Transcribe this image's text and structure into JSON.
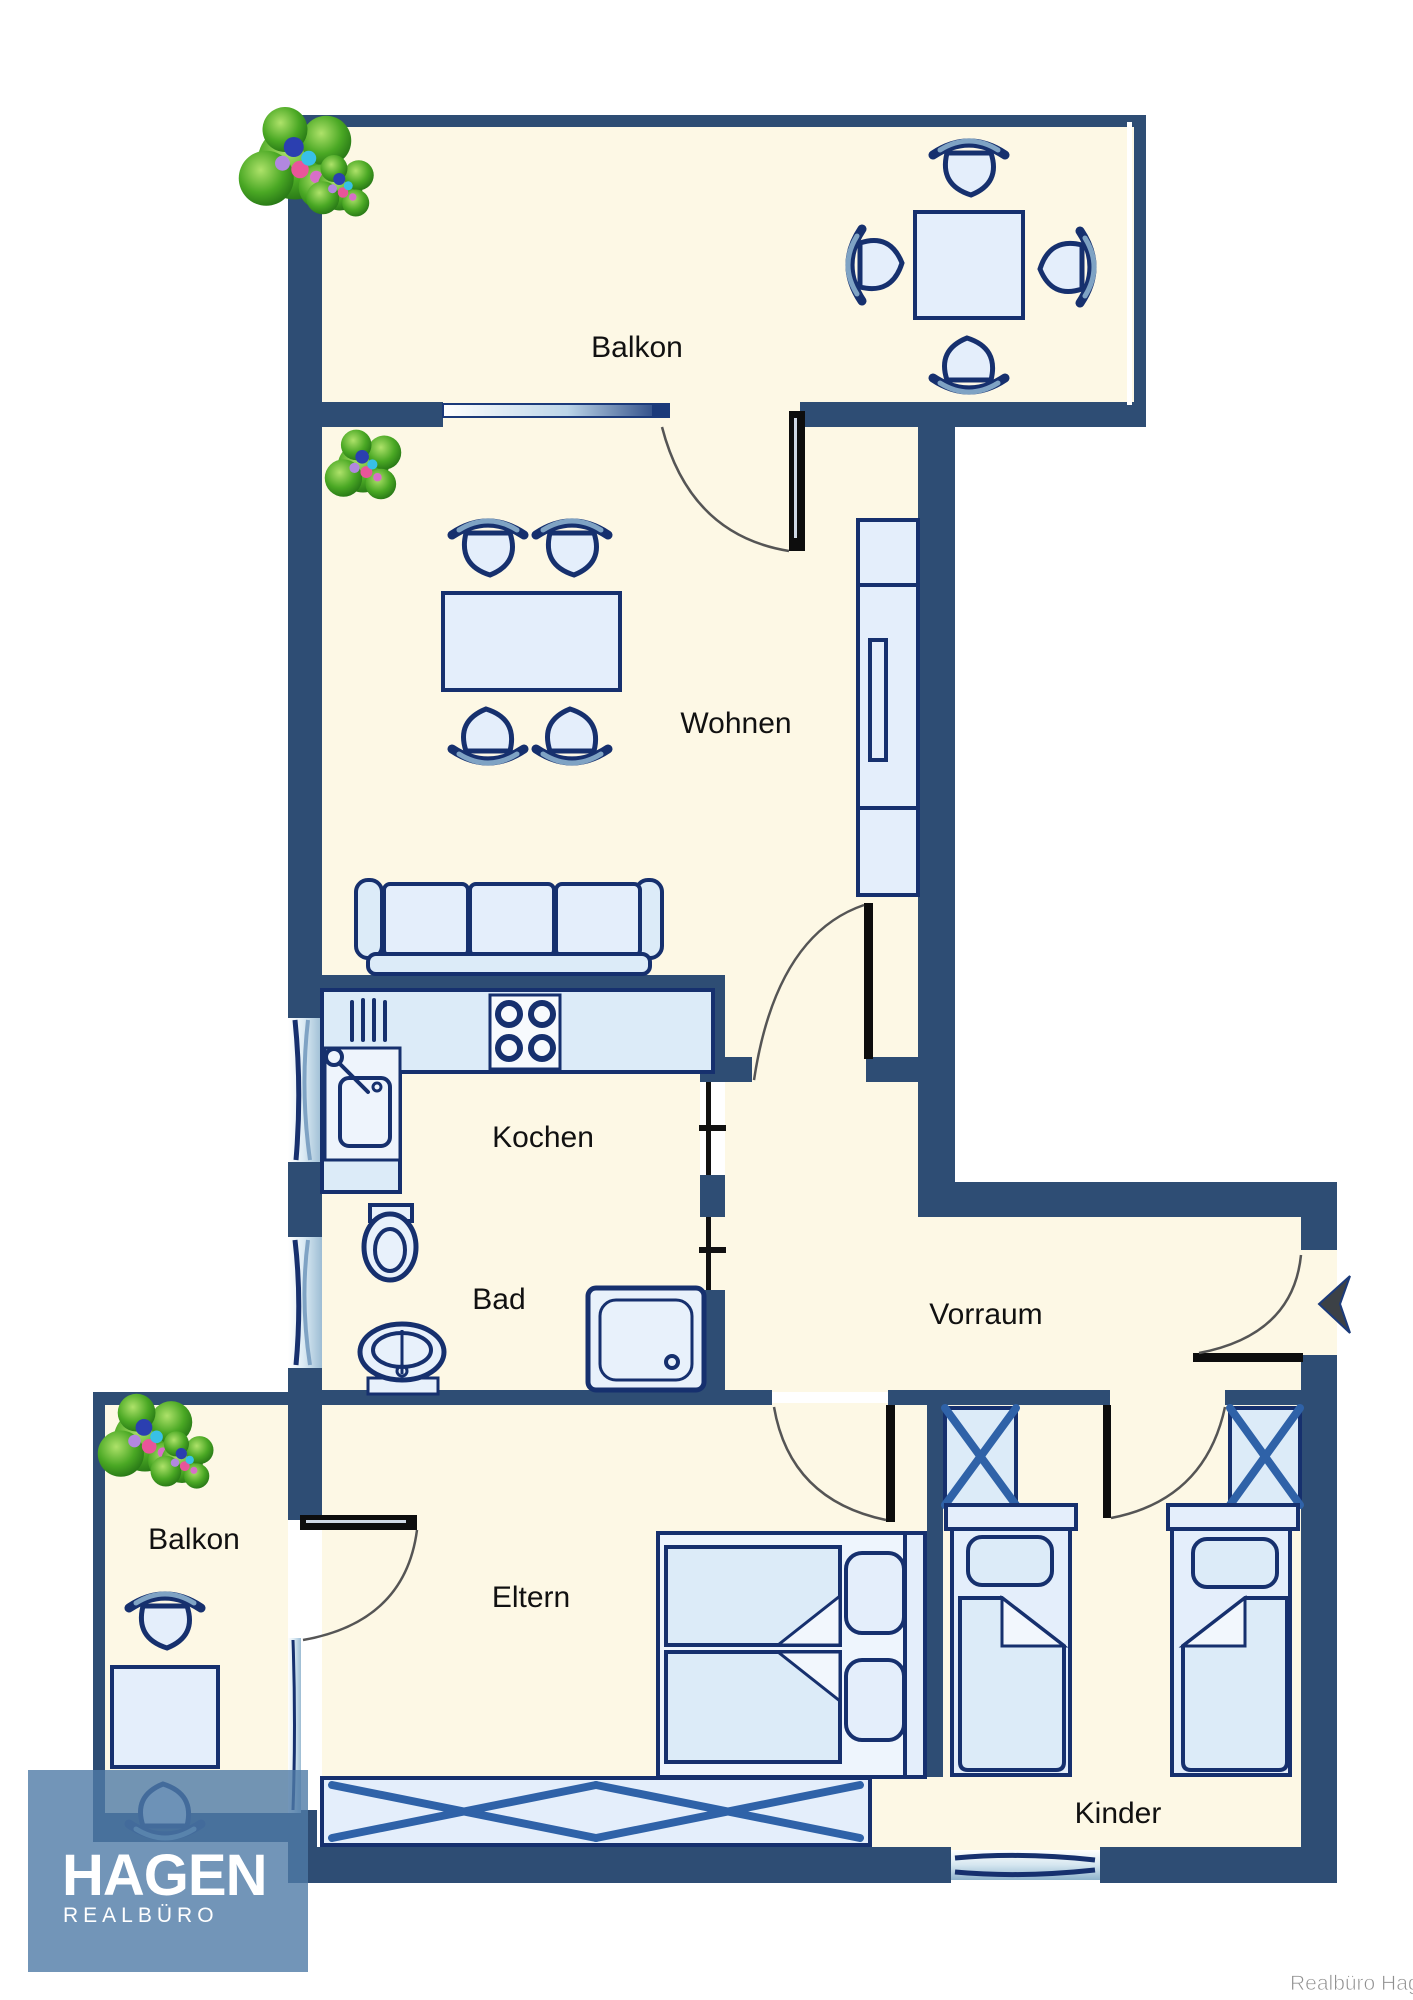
{
  "brand": {
    "logo_title": "HAGEN",
    "logo_subtitle": "REALBÜRO",
    "watermark": "Realbüro Hagen"
  },
  "rooms": {
    "balkon_top": {
      "label": "Balkon"
    },
    "wohnen": {
      "label": "Wohnen"
    },
    "kochen": {
      "label": "Kochen"
    },
    "bad": {
      "label": "Bad"
    },
    "vorraum": {
      "label": "Vorraum"
    },
    "balkon_left": {
      "label": "Balkon"
    },
    "eltern": {
      "label": "Eltern"
    },
    "kinder": {
      "label": "Kinder"
    }
  },
  "colors": {
    "wall": "#2e4d74",
    "floor": "#fdf8e5",
    "furniture_fill": "#e4eefb",
    "furniture_stroke": "#16306e",
    "wardrobe_cross": "#2f62a8",
    "logo_overlay": "#4f7aa6",
    "label_text": "#111111",
    "watermark_text": "#8f8f8f",
    "plant_green": "#3d9a1d"
  },
  "icons": [
    "plant-icon",
    "dining-table-icon",
    "chair-icon",
    "sofa-icon",
    "cabinet-icon",
    "kitchen-counter-icon",
    "stove-icon",
    "kitchen-sink-icon",
    "toilet-icon",
    "washbasin-icon",
    "shower-icon",
    "wardrobe-icon",
    "single-bed-icon",
    "double-bed-icon",
    "sideboard-icon",
    "door-icon",
    "window-icon",
    "entrance-arrow-icon"
  ]
}
